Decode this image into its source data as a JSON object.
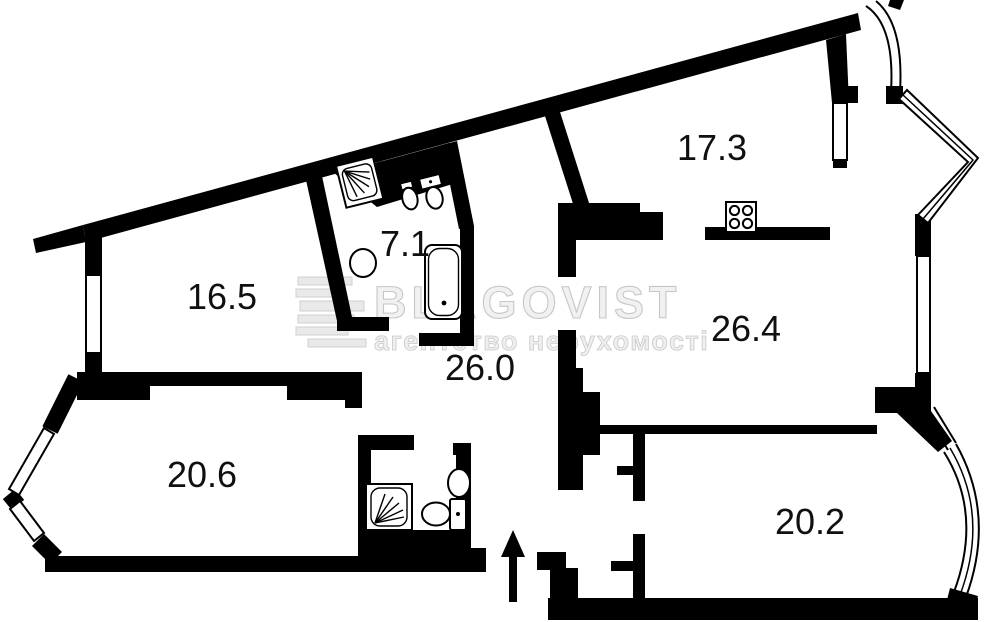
{
  "plan": {
    "background_color": "#ffffff",
    "wall_color": "#000000",
    "rooms": [
      {
        "name": "room-top-left",
        "label": "16.5"
      },
      {
        "name": "bathroom-top",
        "label": "7.1"
      },
      {
        "name": "kitchen",
        "label": "17.3"
      },
      {
        "name": "hallway",
        "label": "26.0"
      },
      {
        "name": "living-right",
        "label": "26.4"
      },
      {
        "name": "room-bottom-left",
        "label": "20.6"
      },
      {
        "name": "room-bottom-right",
        "label": "20.2"
      }
    ],
    "icons": [
      "shower-icon",
      "bidet-icon",
      "toilet-icon",
      "wash-basin-icon",
      "bathtub-icon",
      "stove-icon",
      "shower-2-icon",
      "wash-basin-2-icon",
      "toilet-2-icon",
      "entrance-arrow-icon"
    ],
    "watermark": {
      "brand": "BLAGOVIST",
      "tagline": "агентство нерухомості",
      "color": "#e9e9e9"
    }
  }
}
